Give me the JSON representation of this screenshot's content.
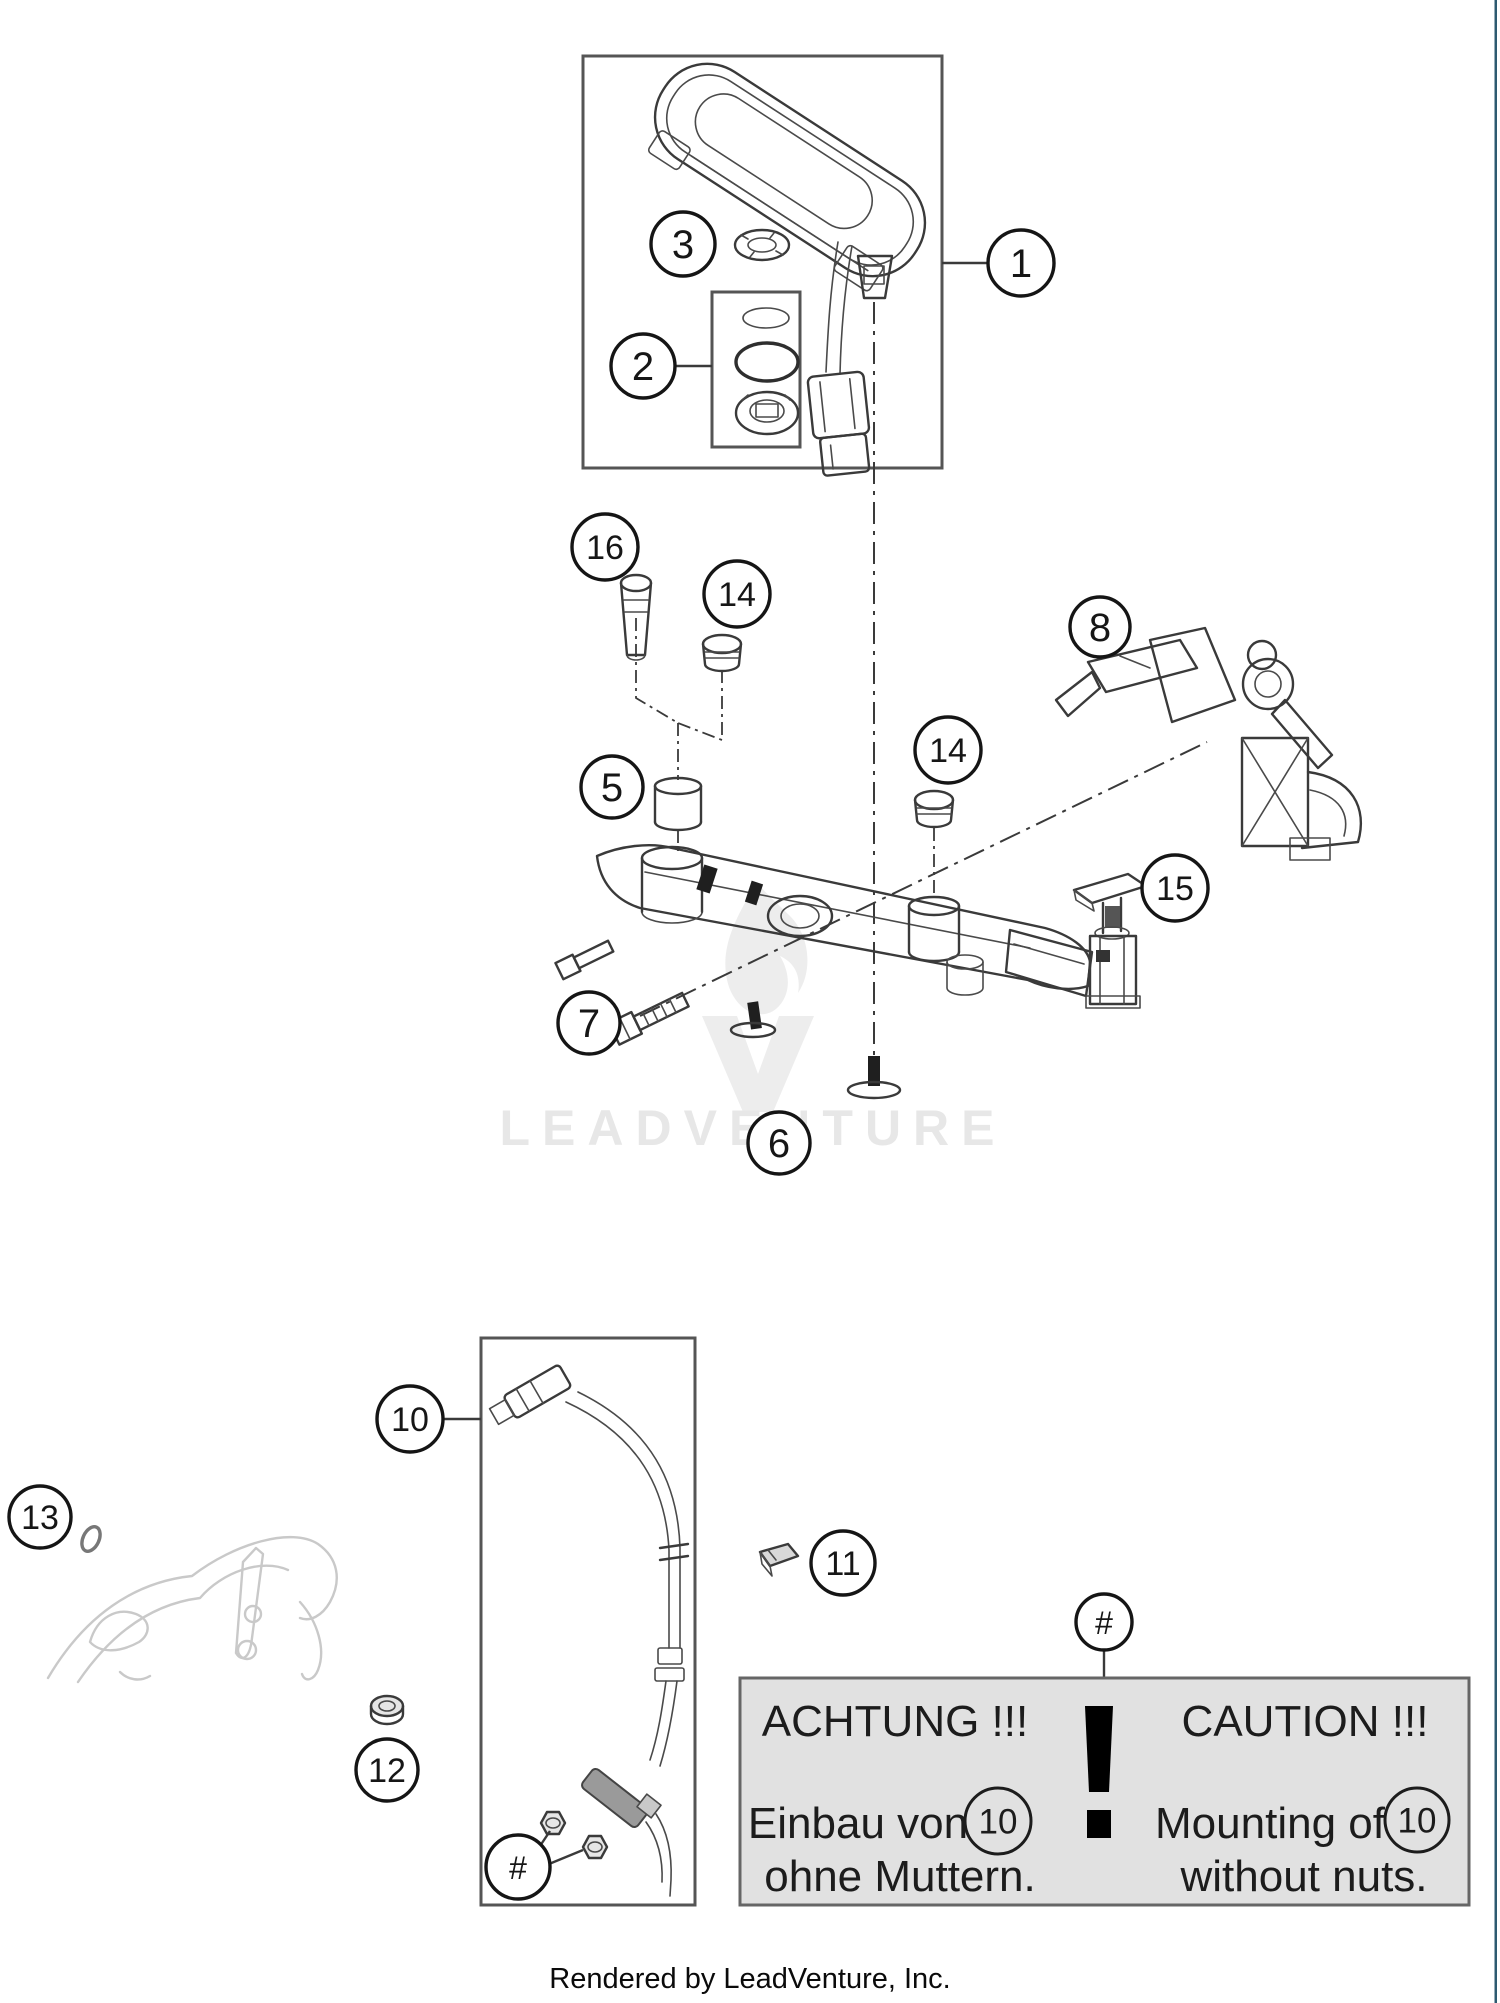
{
  "page": {
    "right_border_color": "#2d5a70",
    "background_color": "#ffffff"
  },
  "watermark": {
    "text": "LEADVENTURE",
    "color": "#e7e7e7"
  },
  "footer": {
    "text": "Rendered by LeadVenture, Inc."
  },
  "callouts": [
    {
      "label": "1",
      "x": 1021,
      "y": 263,
      "r": 33
    },
    {
      "label": "2",
      "x": 643,
      "y": 366,
      "r": 32
    },
    {
      "label": "3",
      "x": 683,
      "y": 244,
      "r": 32
    },
    {
      "label": "5",
      "x": 612,
      "y": 787,
      "r": 31
    },
    {
      "label": "6",
      "x": 779,
      "y": 1143,
      "r": 31
    },
    {
      "label": "7",
      "x": 589,
      "y": 1023,
      "r": 31
    },
    {
      "label": "8",
      "x": 1100,
      "y": 627,
      "r": 30
    },
    {
      "label": "10",
      "x": 410,
      "y": 1419,
      "r": 33
    },
    {
      "label": "11",
      "x": 843,
      "y": 1563,
      "r": 32
    },
    {
      "label": "12",
      "x": 387,
      "y": 1770,
      "r": 31
    },
    {
      "label": "13",
      "x": 40,
      "y": 1517,
      "r": 31
    },
    {
      "label": "14",
      "x": 737,
      "y": 594,
      "r": 33
    },
    {
      "label": "14",
      "x": 948,
      "y": 750,
      "r": 33
    },
    {
      "label": "15",
      "x": 1175,
      "y": 888,
      "r": 33
    },
    {
      "label": "16",
      "x": 605,
      "y": 547,
      "r": 33
    },
    {
      "label": "#",
      "x": 1104,
      "y": 1622,
      "r": 28
    },
    {
      "label": "#",
      "x": 518,
      "y": 1867,
      "r": 32
    }
  ],
  "caution_box": {
    "background": "#e1e1e1",
    "title_de": "ACHTUNG !!!",
    "line1_de": "Einbau von",
    "line2_de": "ohne Muttern.",
    "title_en": "CAUTION !!!",
    "line1_en": "Mounting of",
    "line2_en": "without nuts.",
    "ref": "10"
  }
}
